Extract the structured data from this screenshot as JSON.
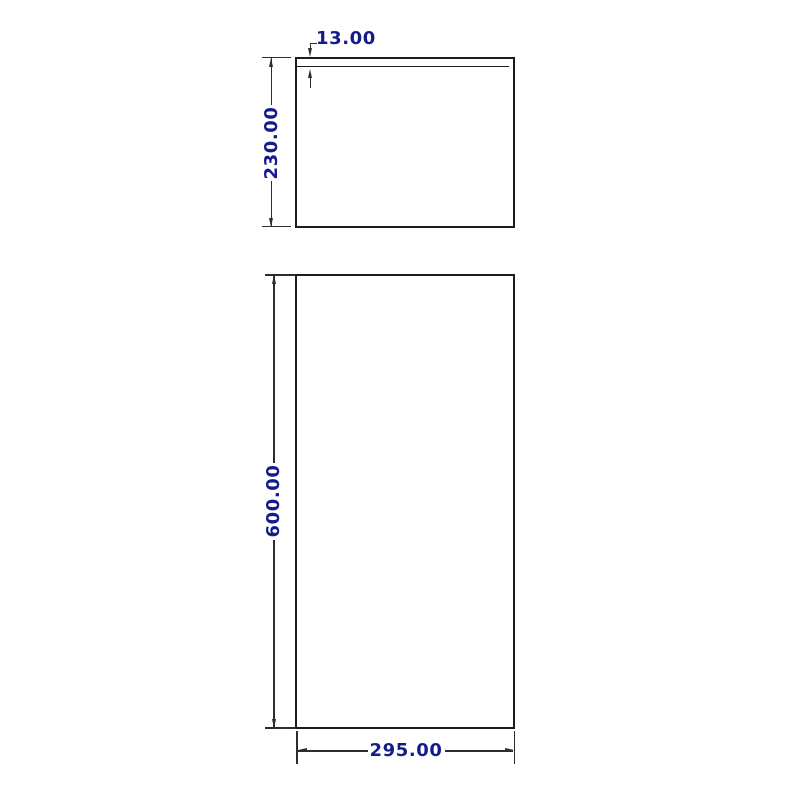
{
  "canvas": {
    "width": 800,
    "height": 800,
    "background": "#ffffff"
  },
  "drawing": {
    "kind": "2D dimensioned technical drawing, two orthographic rectangle views",
    "colors": {
      "outline": "#1c1c1c",
      "dimension_lines": "#2d2d2d",
      "dimension_text": "#141c8c"
    },
    "views": {
      "top": {
        "shape": "rectangle",
        "width_value": 295.0,
        "height_value": 230.0,
        "lid_thickness_value": 13.0
      },
      "front": {
        "shape": "rectangle",
        "width_value": 295.0,
        "height_value": 600.0
      }
    },
    "dimensions": [
      {
        "id": "lid-thickness",
        "label": "13.00",
        "view": "top",
        "orientation": "vertical-gap"
      },
      {
        "id": "top-height",
        "label": "230.00",
        "view": "top",
        "orientation": "vertical"
      },
      {
        "id": "front-height",
        "label": "600.00",
        "view": "front",
        "orientation": "vertical"
      },
      {
        "id": "front-width",
        "label": "295.00",
        "view": "front",
        "orientation": "horizontal"
      }
    ]
  }
}
